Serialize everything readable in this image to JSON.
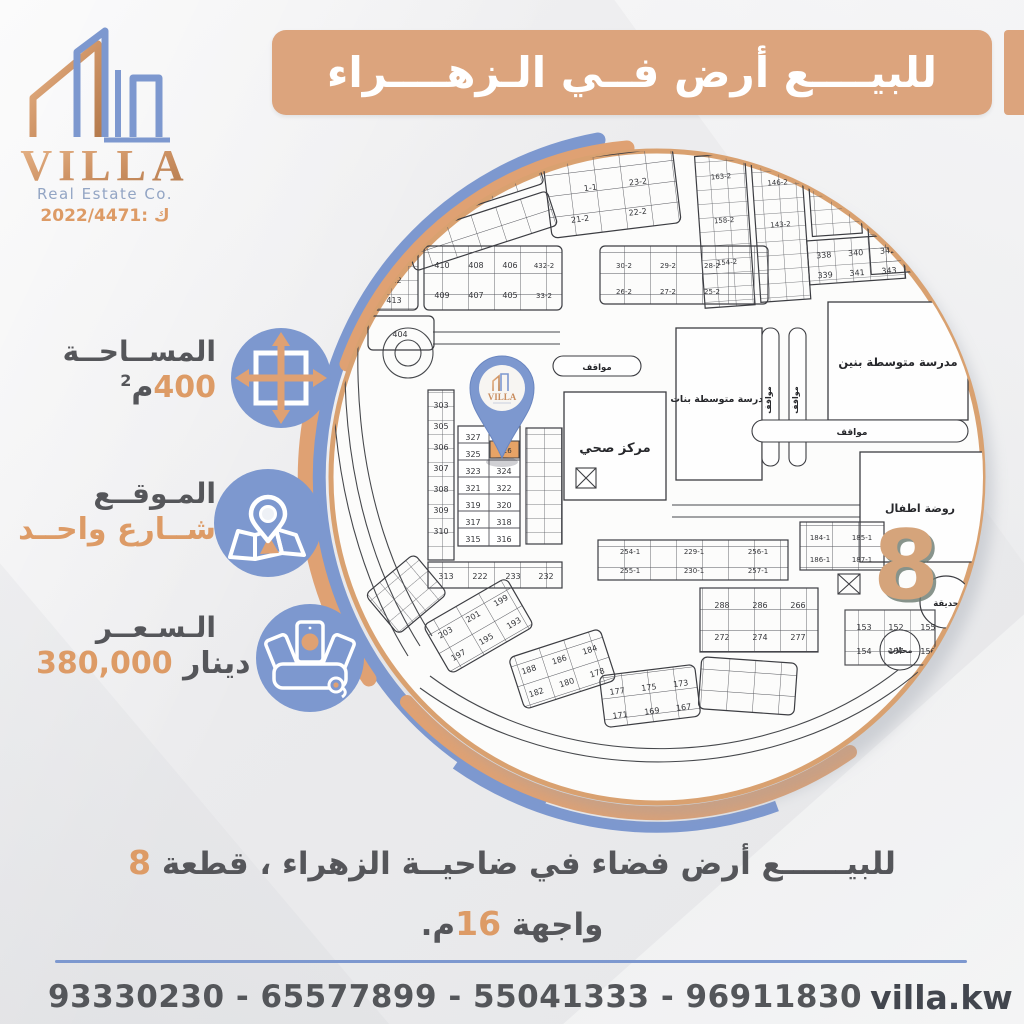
{
  "logo": {
    "name": "VILLA",
    "subtitle": "Real Estate Co.",
    "license": "2022/4471: ك"
  },
  "header": {
    "title": "للبيــــع أرض فــي الـزهــــراء"
  },
  "info": {
    "area": {
      "label": "المســاحــة",
      "value": "400",
      "unit": "م",
      "unit_sup": "2"
    },
    "location": {
      "label": "المـوقــع",
      "value": "شــارع واحــد"
    },
    "price": {
      "label": "الـسـعــر",
      "value": "380,000",
      "unit": "دينار"
    }
  },
  "map": {
    "pin_logo": "VILLA",
    "block_number": "8",
    "labels": {
      "health_center": "مركز صحي",
      "girls_school": "مدرسة متوسطة بنات",
      "boys_school": "مدرسة متوسطة بنين",
      "kindergarten": "روضة اطفال",
      "park": "حديقة",
      "shops": "محلات",
      "parking": "مواقف"
    },
    "plots": {
      "highlight": "326",
      "strip": [
        "303",
        "305",
        "306",
        "307",
        "308",
        "309",
        "310"
      ],
      "colA": [
        "327",
        "325",
        "323",
        "321",
        "319",
        "317",
        "315"
      ],
      "colB": [
        "324",
        "322",
        "320",
        "318",
        "316"
      ],
      "below": [
        "313",
        "222",
        "233",
        "232"
      ],
      "top_left": [
        "411",
        "412",
        "413",
        "404"
      ],
      "mid_grid": [
        "410",
        "408",
        "406",
        "432-2",
        "409",
        "407",
        "405",
        "33-2"
      ],
      "mid_right": [
        "30-2",
        "29-2",
        "28-2",
        "26-2",
        "27-2",
        "25-2"
      ],
      "top_mid": [
        "23-2",
        "1-1",
        "21-2",
        "22-2"
      ],
      "top_right": [
        "163-2",
        "158-2",
        "154-2",
        "146-2",
        "143-2",
        "342-2"
      ],
      "tr_block": [
        "338",
        "340",
        "342",
        "339",
        "341",
        "343"
      ],
      "seq_row": [
        "254-1",
        "229-1",
        "256-1",
        "255-1",
        "230-1",
        "257-1"
      ],
      "k_block": [
        "184-1",
        "185-1",
        "186-1",
        "187-1"
      ],
      "right1": [
        "288",
        "286",
        "266",
        "272",
        "274",
        "277"
      ],
      "right2": [
        "153",
        "152",
        "155",
        "154",
        "157",
        "156"
      ],
      "fan1": [
        "203",
        "201",
        "199",
        "197",
        "195",
        "193"
      ],
      "fan2": [
        "188",
        "186",
        "184",
        "182",
        "180",
        "178"
      ],
      "fan3": [
        "177",
        "175",
        "173",
        "171",
        "169",
        "167"
      ]
    }
  },
  "description": {
    "line1": "للبيــــــع أرض فضاء في ضاحيــة الزهراء ، قطعة ",
    "line1_number": "8",
    "line2_pre": "واجهة ",
    "line2_number": "16",
    "line2_post": "م."
  },
  "footer": {
    "phones": "93330230 - 65577899 - 55041333 - 96911830",
    "instagram_handle": "villa.kw"
  },
  "colors": {
    "tan": "#dca47d",
    "blue": "#7d98cf",
    "orange_text": "#dd9b66",
    "dark_text": "#55565a"
  }
}
